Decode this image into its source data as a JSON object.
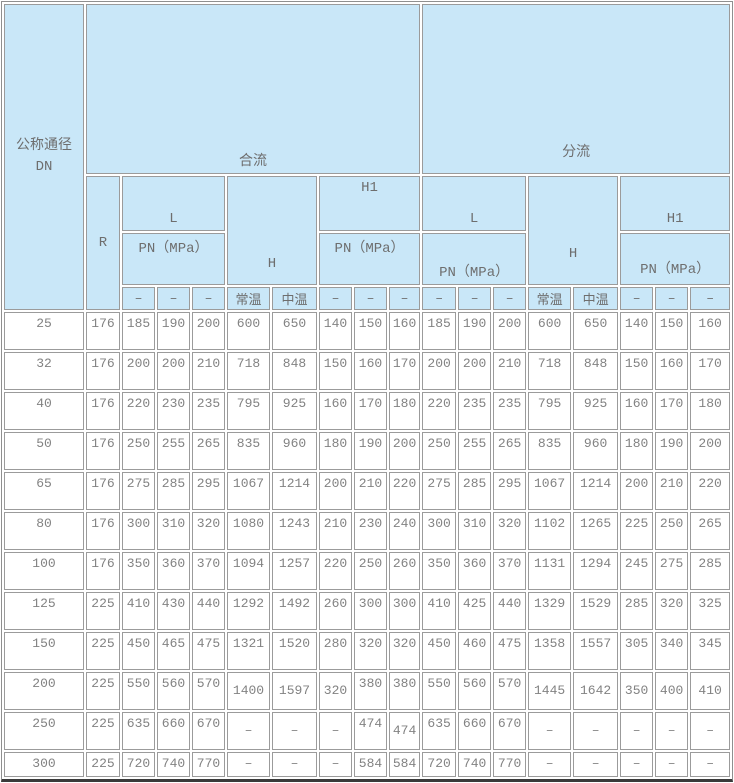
{
  "page": {
    "background": "#ffffff"
  },
  "table": {
    "header_bg": "#c9e7f8",
    "border_color": "#9b9b9b",
    "text_color": "#828282",
    "headers": {
      "corner": "公称通径\nDN",
      "merge_flow": "合流",
      "split_flow": "分流",
      "r": "R",
      "l": "L",
      "h": "H",
      "h1": "H1",
      "pn": "PN（MPa）",
      "normal_temp": "常温",
      "medium_temp": "中温",
      "dash": "–"
    }
  },
  "chart_data": {
    "type": "table",
    "corner_header": "公称通径 DN",
    "groups": [
      {
        "label": "合流",
        "subcolumns": [
          "R",
          "L PN（MPa） –",
          "L PN（MPa） –",
          "L PN（MPa） –",
          "H 常温",
          "H 中温",
          "H1 PN（MPa） –",
          "H1 PN（MPa） –",
          "H1 PN（MPa） –"
        ]
      },
      {
        "label": "分流",
        "subcolumns": [
          "L PN（MPa） –",
          "L PN（MPa） –",
          "L PN（MPa） –",
          "H 常温",
          "H 中温",
          "H1 PN（MPa） –",
          "H1 PN（MPa） –",
          "H1 PN（MPa） –"
        ]
      }
    ],
    "rows": [
      [
        25,
        176,
        185,
        190,
        200,
        600,
        650,
        140,
        150,
        160,
        185,
        190,
        200,
        600,
        650,
        140,
        150,
        160
      ],
      [
        32,
        176,
        200,
        200,
        210,
        718,
        848,
        150,
        160,
        170,
        200,
        200,
        210,
        718,
        848,
        150,
        160,
        170
      ],
      [
        40,
        176,
        220,
        230,
        235,
        795,
        925,
        160,
        170,
        180,
        220,
        235,
        235,
        795,
        925,
        160,
        170,
        180
      ],
      [
        50,
        176,
        250,
        255,
        265,
        835,
        960,
        180,
        190,
        200,
        250,
        255,
        265,
        835,
        960,
        180,
        190,
        200
      ],
      [
        65,
        176,
        275,
        285,
        295,
        1067,
        1214,
        200,
        210,
        220,
        275,
        285,
        295,
        1067,
        1214,
        200,
        210,
        220
      ],
      [
        80,
        176,
        300,
        310,
        320,
        1080,
        1243,
        210,
        230,
        240,
        300,
        310,
        320,
        1102,
        1265,
        225,
        250,
        265
      ],
      [
        100,
        176,
        350,
        360,
        370,
        1094,
        1257,
        220,
        250,
        260,
        350,
        360,
        370,
        1131,
        1294,
        245,
        275,
        285
      ],
      [
        125,
        225,
        410,
        430,
        440,
        1292,
        1492,
        260,
        300,
        300,
        410,
        425,
        440,
        1329,
        1529,
        285,
        320,
        325
      ],
      [
        150,
        225,
        450,
        465,
        475,
        1321,
        1520,
        280,
        320,
        320,
        450,
        460,
        475,
        1358,
        1557,
        305,
        340,
        345
      ],
      [
        200,
        225,
        550,
        560,
        570,
        1400,
        1597,
        320,
        380,
        380,
        550,
        560,
        570,
        1445,
        1642,
        350,
        400,
        410
      ],
      [
        250,
        225,
        635,
        660,
        670,
        "–",
        "–",
        "–",
        474,
        474,
        635,
        660,
        670,
        "–",
        "–",
        "–",
        "–",
        "–"
      ],
      [
        300,
        225,
        720,
        740,
        770,
        "–",
        "–",
        "–",
        584,
        584,
        720,
        740,
        770,
        "–",
        "–",
        "–",
        "–",
        "–"
      ]
    ]
  }
}
